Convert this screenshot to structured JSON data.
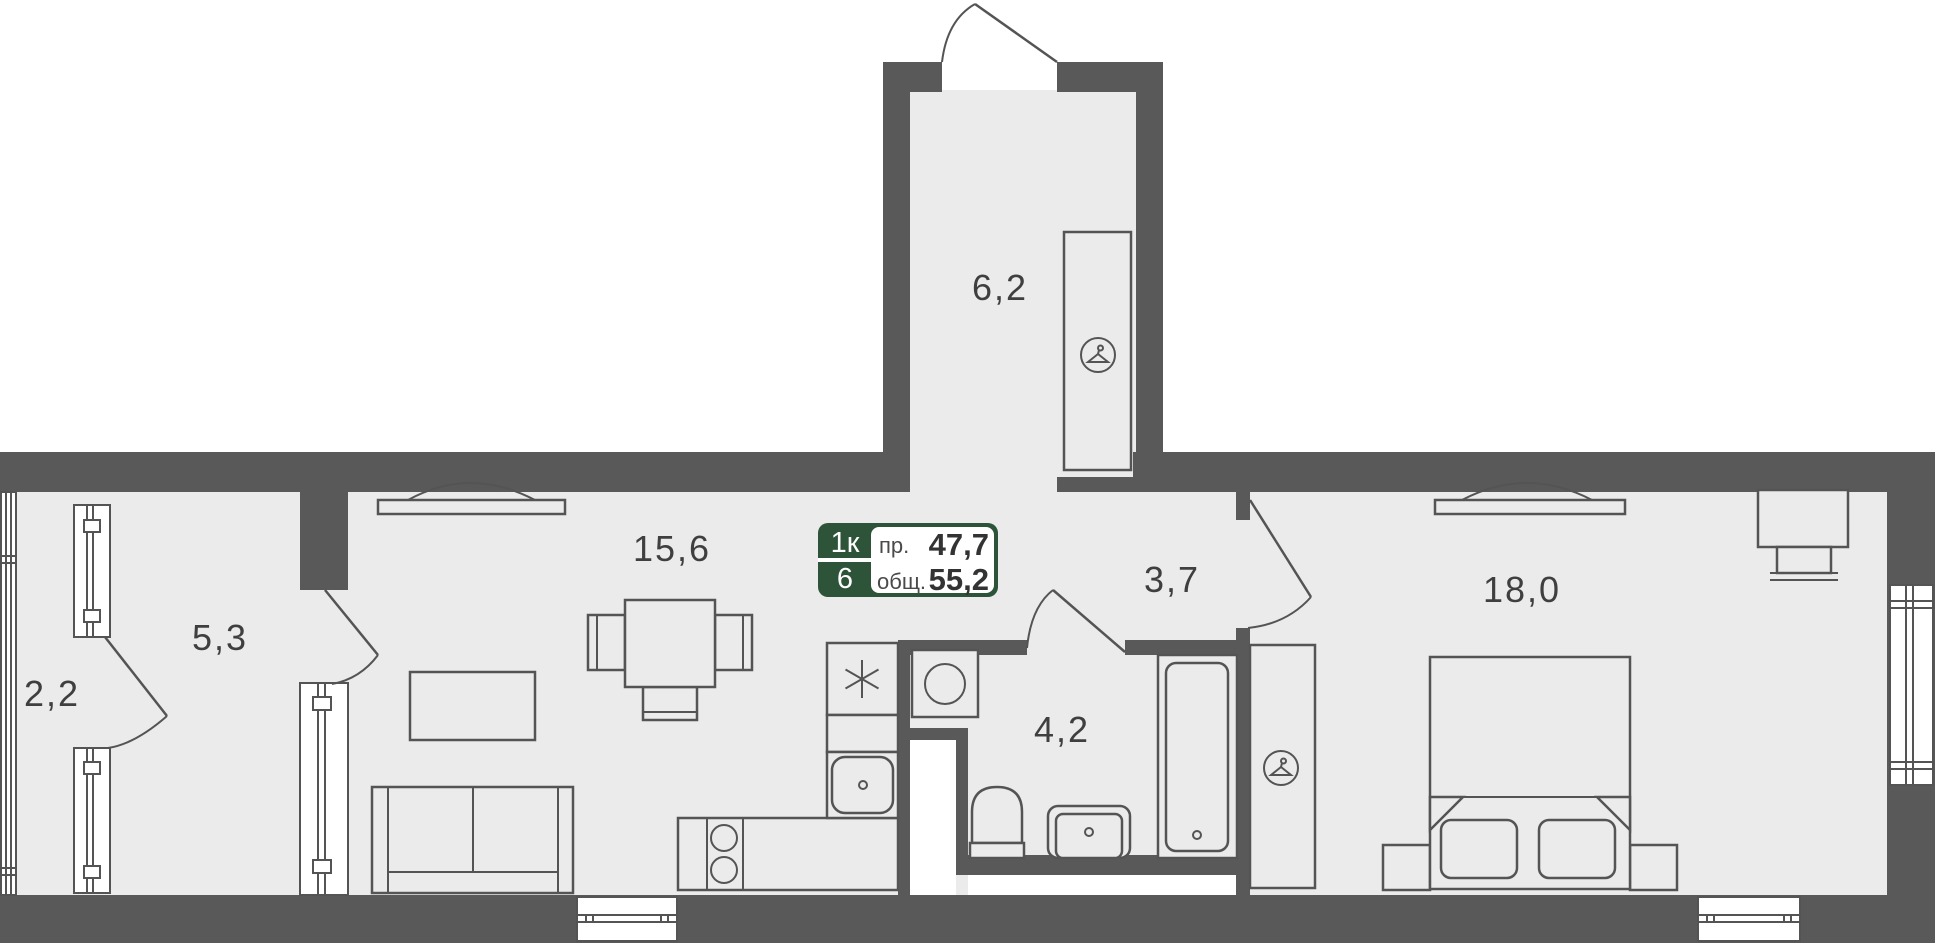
{
  "plan": {
    "title": "apartment-floor-plan",
    "badge": {
      "rooms_label": "1к",
      "floor_label": "6",
      "living_area_label": "пр.",
      "living_area_value": "47,7",
      "total_area_label": "общ.",
      "total_area_value": "55,2"
    },
    "rooms": {
      "entry_hall": {
        "area": "6,2"
      },
      "living_kitchen": {
        "area": "15,6"
      },
      "corridor": {
        "area": "3,7"
      },
      "bedroom": {
        "area": "18,0"
      },
      "inner_room": {
        "area": "5,3"
      },
      "balcony": {
        "area": "2,2"
      },
      "bathroom": {
        "area": "4,2"
      }
    },
    "icons": {
      "wardrobe_hall": "hanger-icon",
      "wardrobe_bedroom": "hanger-icon",
      "fridge": "asterisk-icon"
    },
    "colors": {
      "wall": "#595959",
      "floor": "#ebebeb",
      "line": "#545454",
      "text": "#3f3f3f",
      "badge_green": "#2d5438",
      "white": "#ffffff"
    }
  }
}
